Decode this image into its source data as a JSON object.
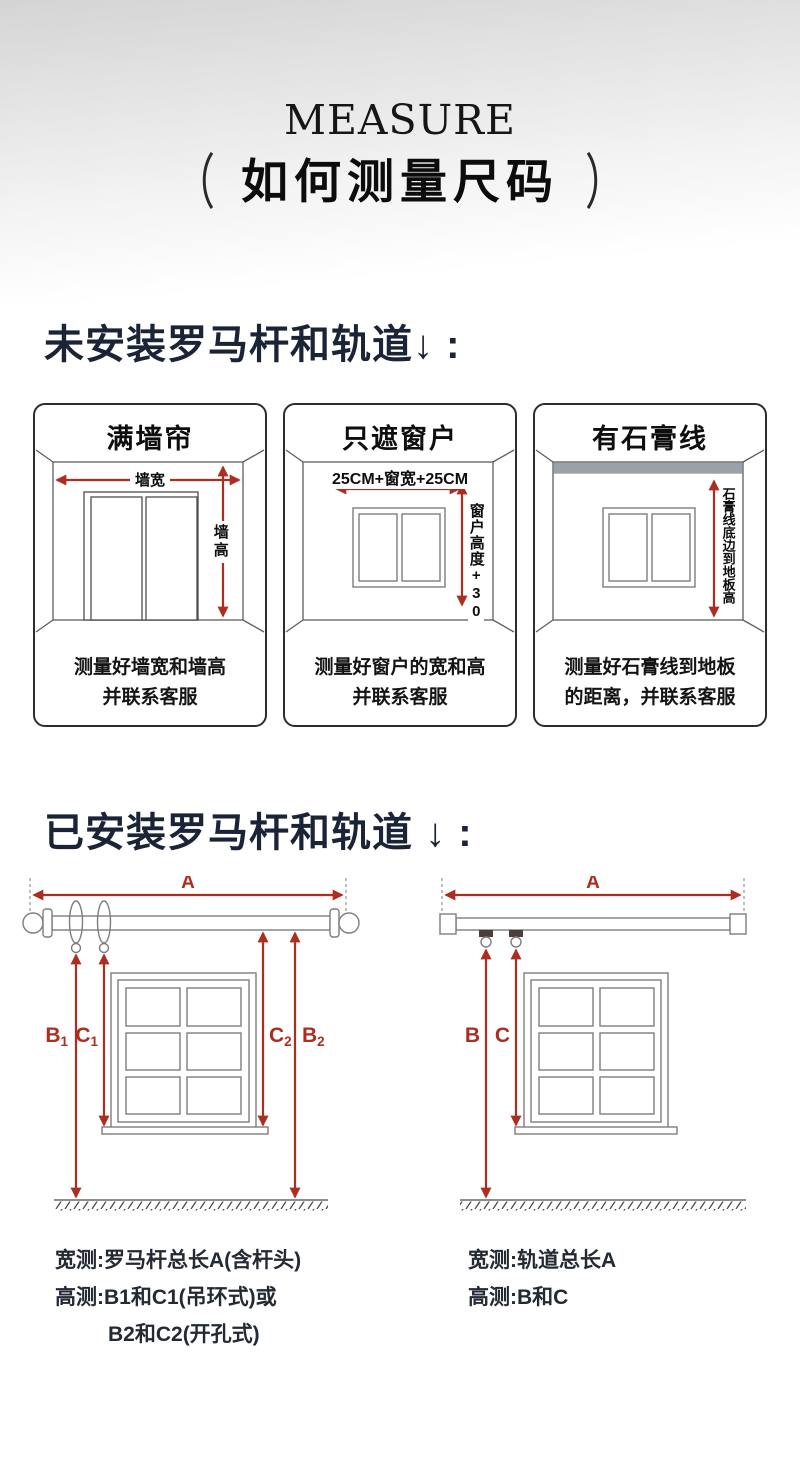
{
  "header": {
    "eyebrow": "MEASURE",
    "paren_left": "（",
    "paren_right": "）",
    "title": "如何测量尺码"
  },
  "section1": {
    "heading": "未安装罗马杆和轨道↓ :",
    "boxes": [
      {
        "title": "满墙帘",
        "width_label": "墙宽",
        "height_label": "墙高",
        "caption": [
          "测量好墙宽和墙高",
          "并联系客服"
        ]
      },
      {
        "title": "只遮窗户",
        "width_label": "25CM+窗宽+25CM",
        "height_label": "窗户高度+30",
        "caption": [
          "测量好窗户的宽和高",
          "并联系客服"
        ]
      },
      {
        "title": "有石膏线",
        "height_label": "石膏线底边到地板高",
        "caption": [
          "测量好石膏线到地板",
          "的距离，并联系客服"
        ]
      }
    ]
  },
  "section2": {
    "heading": "已安装罗马杆和轨道 ↓ :",
    "rod_diagram": {
      "A": "A",
      "B1": {
        "b": "B",
        "s": "1"
      },
      "C1": {
        "b": "C",
        "s": "1"
      },
      "C2": {
        "b": "C",
        "s": "2"
      },
      "B2": {
        "b": "B",
        "s": "2"
      }
    },
    "track_diagram": {
      "A": "A",
      "B": "B",
      "C": "C"
    },
    "rod_notes": [
      "宽测:罗马杆总长A(含杆头)",
      "高测:B1和C1(吊环式)或",
      "B2和C2(开孔式)"
    ],
    "track_notes": [
      "宽测:轨道总长A",
      "高测:B和C"
    ]
  },
  "colors": {
    "accent_red": "#ad2e21",
    "heading_navy": "#1b2436",
    "plaster_gray": "#99a1a9"
  }
}
